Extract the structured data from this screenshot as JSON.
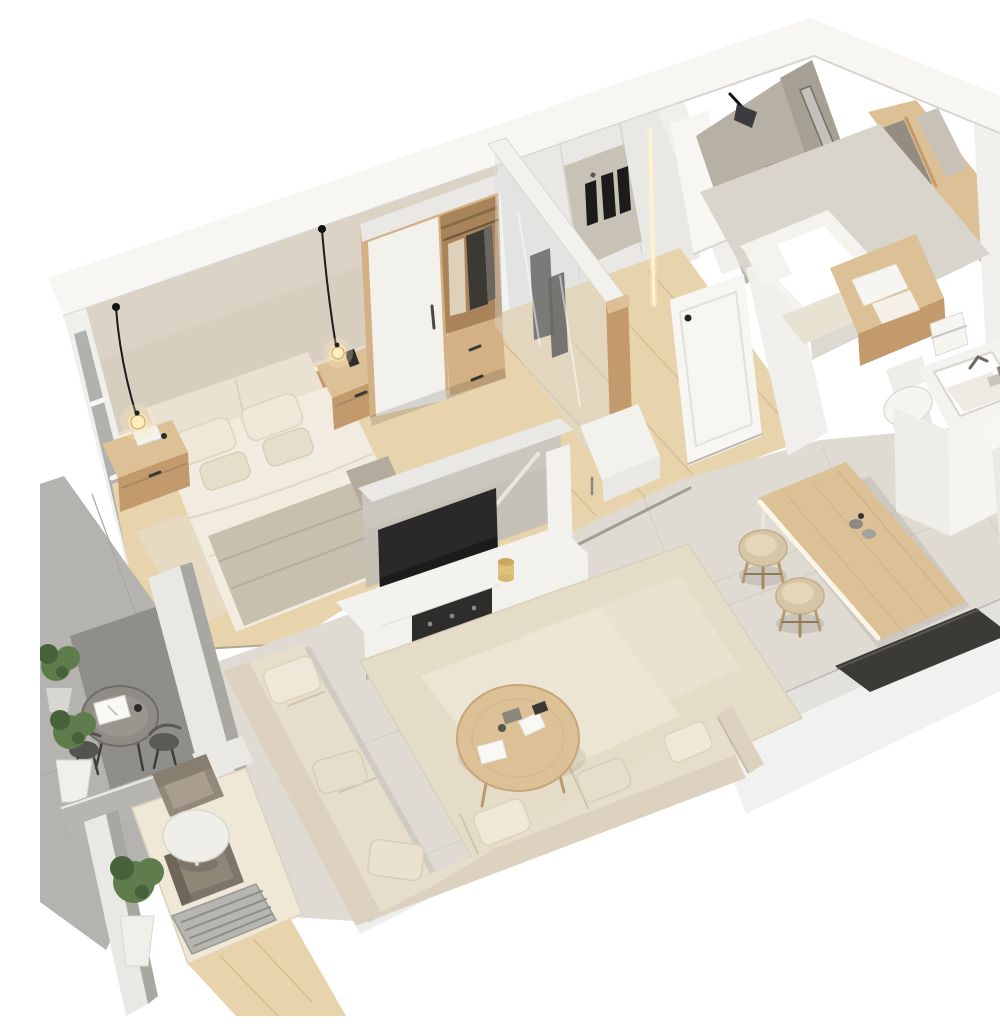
{
  "meta": {
    "title": "3D isometric cutaway rendering of a one-bedroom apartment floor plan",
    "description": "Photoreal dollhouse-style render: bedroom with double bed, wardrobe and pendant lamps; glass walk-in closet; entry hall with bench; bathroom with shower, bathtub, vanity, toilet and sink; kitchen counter with cooktop and oven; wooden dining table with two stools; living room with L-shaped beige sofa, round wood coffee table, TV on white media console; wrap-around balcony with bistro table, lounge armchairs and potted plants.",
    "view": "isometric-cutaway",
    "style": "photorealistic architectural render, neutral beige/white/wood palette"
  },
  "palette": {
    "wall_bright": "#f7f6f3",
    "wall_white": "#f0efeb",
    "wall_soft": "#e9e8e4",
    "wall_shadow": "#d8d5d0",
    "wall_grey": "#a9a7a2",
    "wall_grey_light": "#b7b5b0",
    "wall_beige": "#d7cec0",
    "beige_dark": "#c8bead",
    "wood": "#c29a6b",
    "wood_mid": "#d3b184",
    "wood_light": "#dcc096",
    "wood_dark": "#a9835a",
    "wood_floor": "#e7d3ac",
    "wood_seam": "#d4bb90",
    "carpet": "#e6dbc2",
    "concrete_floor": "#dfdbd2",
    "tile_seam": "#d0ccc1",
    "grey_floor": "#b4b3af",
    "grey_floor_dark": "#8f8e8a",
    "concrete_wall": "#b7b0a5",
    "concrete_wall2": "#a69f93",
    "partition": "#c6c1b7",
    "sofa": "#dcd2bf",
    "sofa_dark": "#c8bca6",
    "cushion": "#e7ddcb",
    "pillow": "#efe8d8",
    "rug": "#e5dcc8",
    "rug_light": "#efe8d7",
    "bed": "#f1ecdf",
    "blanket": "#c8bfae",
    "headboard": "#e9e2d3",
    "foot_roll": "#b3ab9e",
    "tv": "#1c1c1c",
    "dark": "#3b3a37",
    "metal": "#55534e",
    "console": "#f3f1ec",
    "stool": "#d7c6a6",
    "stool_hi": "#e4d6b6",
    "plant": "#5e7c4c",
    "plant_dark": "#47613a",
    "pot": "#f1efe9",
    "tub": "#f5f3ee",
    "fixture": "#eeede8",
    "mirror": "#c8c2b6",
    "mirror_dark": "#938d81",
    "led": "#fff3d2",
    "glow": "#ffe9b8",
    "glass": "#d9dedc",
    "taupe": "#93897b",
    "taupe_dark": "#7d7569",
    "towel": "#f7f5f0",
    "bath_floor": "#d9d5cc",
    "appliance": "#2a2a27",
    "paper": "#f9f8f4",
    "cord": "#1b1b1b"
  },
  "scene": {
    "rooms": [
      {
        "name": "bedroom",
        "furniture": [
          "double bed",
          "upholstered headboard",
          "grey throw blanket",
          "4 pillows",
          "wood nightstand left",
          "wood nightstand right",
          "2 black pendant lamps (lit)",
          "wardrobe with white sliding door, open hanging section and drawers",
          "beige carpet",
          "LED cove lighting on beige back wall"
        ]
      },
      {
        "name": "walk-in closet",
        "furniture": [
          "glass partition with wood corner post",
          "mirror panel",
          "hanging dark garments",
          "white cabinet wall"
        ]
      },
      {
        "name": "entry hall",
        "furniture": [
          "white entry door with black handle",
          "white upholstered bench",
          "light oak plank floor",
          "LED door-frame strip"
        ]
      },
      {
        "name": "bathroom",
        "furniture": [
          "concrete shower walls",
          "black wall lamp",
          "glass shower screen",
          "white bathtub",
          "beige bath mat",
          "wood vanity bench with towels",
          "wood framed mirrors",
          "towel rail",
          "toilet",
          "white sink unit with square basin"
        ]
      },
      {
        "name": "kitchen",
        "furniture": [
          "tall white cabinets",
          "white counter",
          "dark cooktop",
          "dark built-in oven"
        ]
      },
      {
        "name": "dining area",
        "furniture": [
          "light wood dining table with LED edge",
          "2 beige bar stools",
          "dark bench ledge",
          "small jars on table"
        ]
      },
      {
        "name": "living room",
        "furniture": [
          "L-shaped beige sectional sofa with pillows",
          "round wood coffee table with papers",
          "large beige area rug",
          "half-height concrete partition",
          "flat-screen TV",
          "white media console with speaker panel",
          "floor reading lamp",
          "yellow candle"
        ]
      },
      {
        "name": "balcony",
        "furniture": [
          "round metal bistro table with open book",
          "2 dark metal chairs",
          "3 potted green plants",
          "grey tile floor",
          "dark floor platform"
        ]
      },
      {
        "name": "lounge nook",
        "furniture": [
          "2 taupe armchairs",
          "round white side table",
          "potted shrub in white pot",
          "white ottoman",
          "metal floor vent grille",
          "beige rug",
          "wood floor strip"
        ]
      }
    ]
  }
}
